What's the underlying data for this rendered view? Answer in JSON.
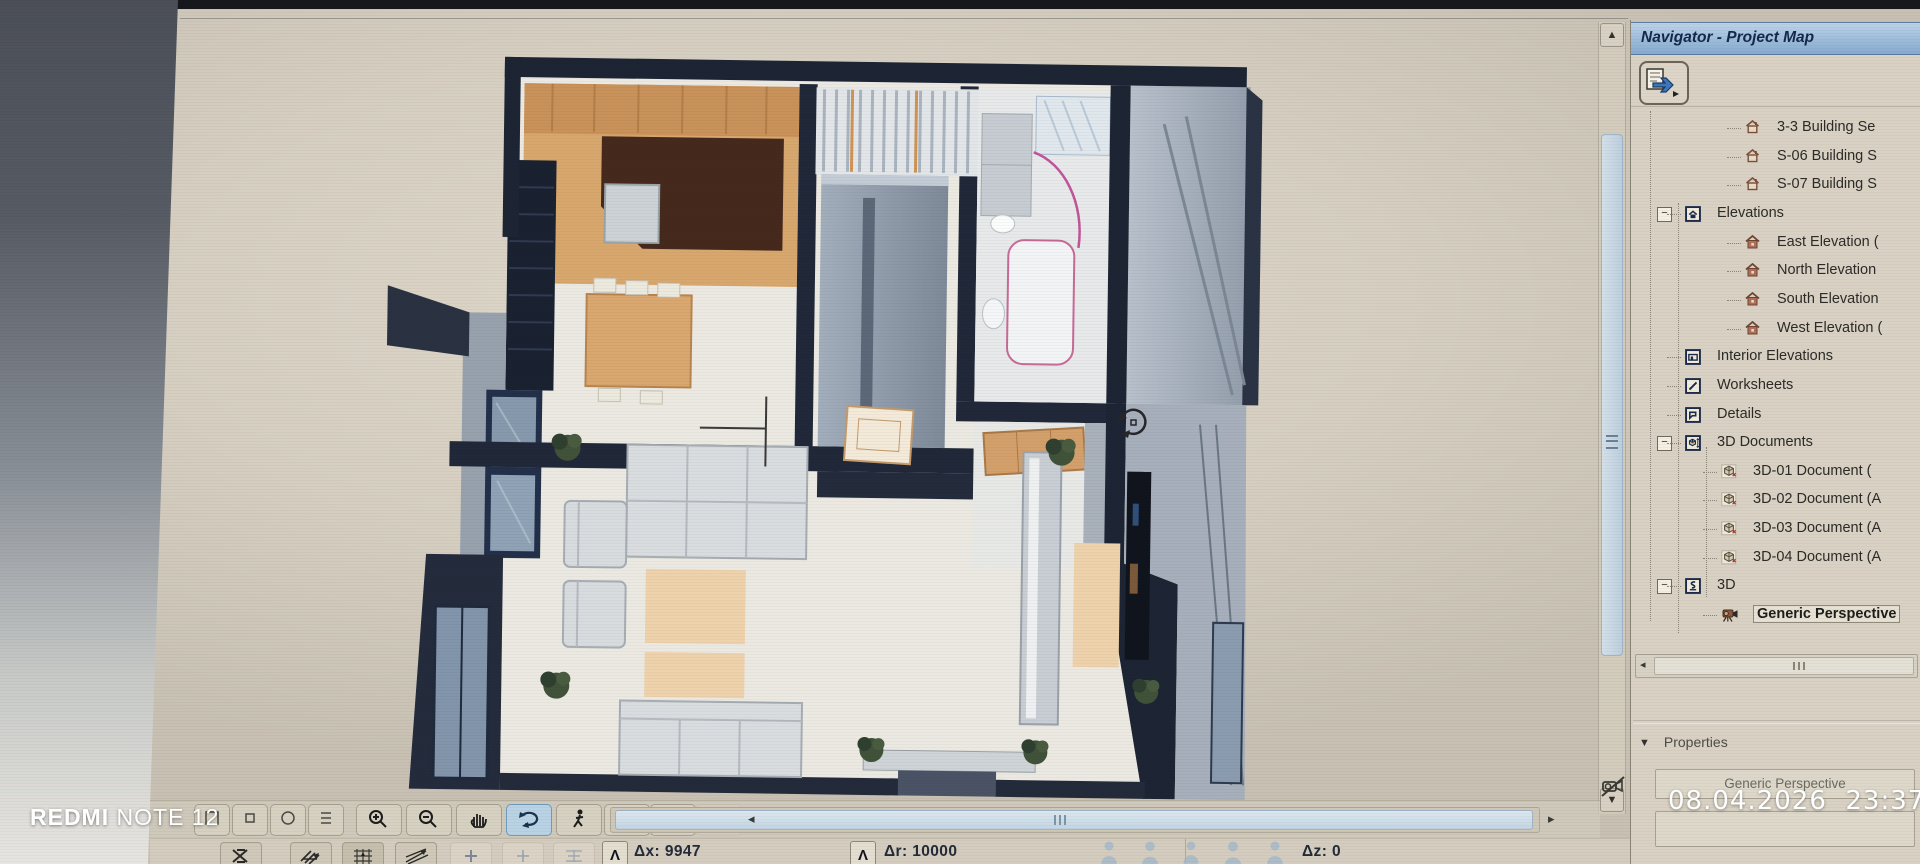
{
  "watermark": {
    "device_brand": "REDMI",
    "device_model": " NOTE 12",
    "timestamp": "08.04.2026  23:37"
  },
  "navigator": {
    "title": "Navigator - Project Map",
    "items": [
      {
        "label": "3-3 Building Se",
        "icon": "building-section",
        "level": 4
      },
      {
        "label": "S-06 Building S",
        "icon": "building-section",
        "level": 4
      },
      {
        "label": "S-07 Building S",
        "icon": "building-section",
        "level": 4
      },
      {
        "label": "Elevations",
        "icon": "elevation-folder",
        "level": 2,
        "expander": "minus"
      },
      {
        "label": "East Elevation (",
        "icon": "elevation",
        "level": 4
      },
      {
        "label": "North Elevation",
        "icon": "elevation",
        "level": 4
      },
      {
        "label": "South Elevation",
        "icon": "elevation",
        "level": 4
      },
      {
        "label": "West Elevation (",
        "icon": "elevation",
        "level": 4
      },
      {
        "label": "Interior Elevations",
        "icon": "interior-elevation",
        "level": 2
      },
      {
        "label": "Worksheets",
        "icon": "worksheet",
        "level": 2
      },
      {
        "label": "Details",
        "icon": "detail",
        "level": 2
      },
      {
        "label": "3D Documents",
        "icon": "document-3d-folder",
        "level": 2,
        "expander": "minus"
      },
      {
        "label": "3D-01 Document (",
        "icon": "document-3d",
        "level": 3
      },
      {
        "label": "3D-02 Document (A",
        "icon": "document-3d",
        "level": 3
      },
      {
        "label": "3D-03 Document (A",
        "icon": "document-3d",
        "level": 3
      },
      {
        "label": "3D-04 Document (A",
        "icon": "document-3d",
        "level": 3
      },
      {
        "label": "3D",
        "icon": "folder-3d",
        "level": 2,
        "expander": "minus"
      },
      {
        "label": "Generic Perspective",
        "icon": "camera",
        "level": 3,
        "selected": true
      }
    ]
  },
  "properties": {
    "header": "Properties",
    "view_name": "Generic Perspective"
  },
  "statusbar": {
    "tools": [
      "hidden-tool-1",
      "hidden-tool-2",
      "hidden-tool-3",
      "hidden-tool-4",
      "zoom-in",
      "zoom-out",
      "pan",
      "orbit",
      "explore",
      "fit-in-window",
      "previous-zoom",
      "next-zoom"
    ],
    "active_tool": "orbit",
    "tracker": {
      "dx": "Δx: 9947",
      "dr": "Δr: 10000",
      "dz": "Δz: 0"
    }
  },
  "colors": {
    "navigator_titlebar": "#9dbcda",
    "active_tool_highlight": "#b9d2e4",
    "wall_dark": "#1d2433",
    "kitchen_wood": "#d8a76d",
    "screen_beige": "#d6cfc1"
  }
}
